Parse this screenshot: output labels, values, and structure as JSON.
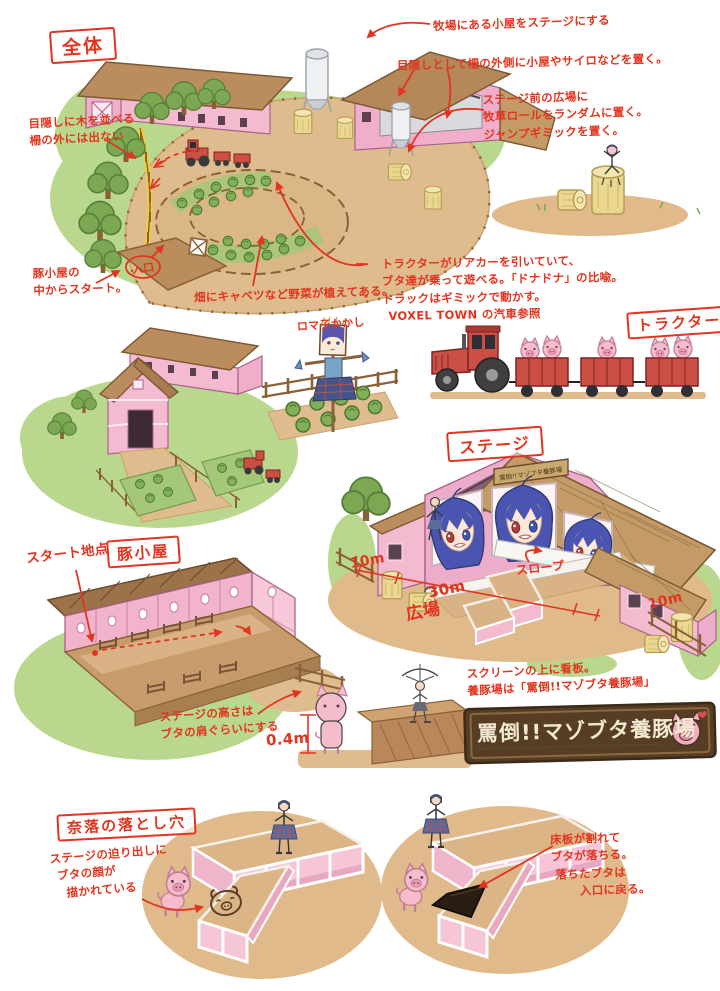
{
  "boxes": {
    "overview": "全体",
    "tractor": "トラクター",
    "stage": "ステージ",
    "pig_hut": "豚小屋",
    "pit": "奈落の落とし穴"
  },
  "notes": {
    "hut_as_stage": "牧場にある小屋をステージにする",
    "blind_buildings": "目隠しとして柵の外側に小屋やサイロなどを置く。",
    "plaza_1": "ステージ前の広場に",
    "plaza_2": "牧草ロールをランダムに置く。",
    "plaza_3": "ジャンプギミックを置く。",
    "trees_1": "目隠しに木を並べる",
    "trees_2": "柵の外には出ない",
    "start_1": "豚小屋の",
    "start_2": "中からスタート。",
    "entrance": "入口",
    "field": "畑にキャベツなど野菜が植えてある。",
    "scarecrow": "ロマ子かかし",
    "tractor_1": "トラクターがリアカーを引いていて、",
    "tractor_2": "ブタ達が乗って遊べる。「ドナドナ」の比喩。",
    "tractor_3": "トラックはギミックで動かす。",
    "tractor_4": "VOXEL TOWN の汽車参照",
    "slope": "スロープ",
    "plaza_label": "広場",
    "dim_left": "10m",
    "dim_mid": "30m",
    "dim_right": "10m",
    "start_point": "スタート地点",
    "height_1": "ステージの高さは",
    "height_2": "ブタの肩ぐらいにする",
    "height_value": "0.4m",
    "sign_1": "スクリーンの上に看板。",
    "sign_2": "養豚場は「罵倒!!マゾブタ養豚場」",
    "board": "罵倒!!マゾブタ養豚場",
    "pit_l1": "ステージの迫り出しに",
    "pit_l2": "ブタの顔が",
    "pit_l3": "描かれている",
    "pit_r1": "床板が割れて",
    "pit_r2": "ブタが落ちる。",
    "pit_r3": "落ちたブタは",
    "pit_r4": "入口に戻る。"
  },
  "colors": {
    "ink": "#e23520",
    "pink_wall": "#f4bbd0",
    "roof_brown": "#bb8d5e",
    "dirt": "#dfbc8e",
    "grass": "#b9d88e",
    "hay": "#ead891",
    "tractor_red": "#cc4f46",
    "pig_pink": "#f5bccb",
    "sign_brown": "#573d24"
  }
}
